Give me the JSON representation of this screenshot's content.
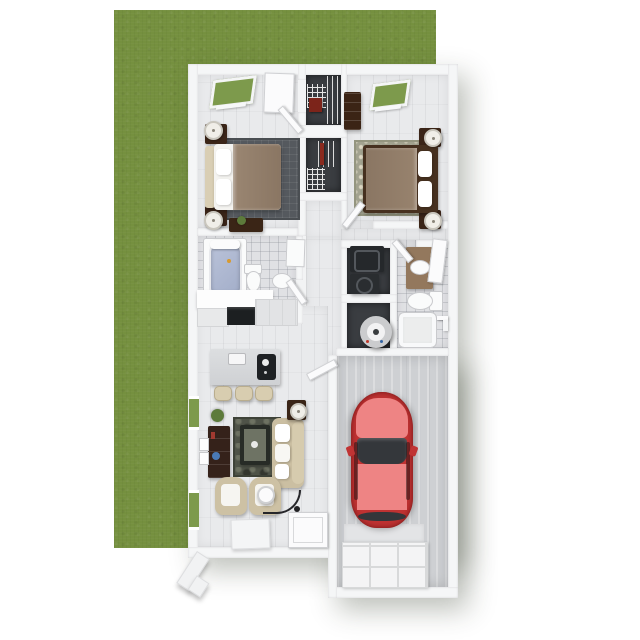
{
  "scene": {
    "title": "3D top-down floor plan render of a one-story apartment with attached single-car garage on a green lawn",
    "view": "overhead dollhouse 3D render",
    "background": "white"
  },
  "palette": {
    "lawn_green": "#75903f",
    "window_green": "#7d9a4c",
    "wall_white": "#f5f6f7",
    "wood_floor": "#e9eaec",
    "tile_floor": "#e0e1e4",
    "closet_dark": "#3a3d41",
    "garage_concrete": "#ced0d3",
    "furniture_wood_dark": "#3b2518",
    "upholstery_beige": "#cdc1a4",
    "blanket_taupe": "#8f7b67",
    "rug_charcoal": "#55595e",
    "rug_sage": "#a2a28f",
    "living_rug": "#4f5348",
    "car_body_red": "#bf3232",
    "car_panel_red": "#ee8484",
    "car_glass": "#34373b",
    "appliance_dark": "#25282b",
    "tub_blue": "#aeb8d2",
    "plant_green": "#5d7b3b"
  },
  "rooms": [
    {
      "name": "Bedroom 1",
      "furniture": [
        "queen bed with taupe blanket",
        "cream headboard",
        "2 nightstands with lamps",
        "charcoal grid rug",
        "desk with plant",
        "skylight window",
        "entry door"
      ]
    },
    {
      "name": "Closet 1",
      "furniture": [
        "white wire shelving",
        "hanging clothes"
      ]
    },
    {
      "name": "Closet 2",
      "furniture": [
        "white wire shelving",
        "hanging clothes"
      ]
    },
    {
      "name": "Bedroom 2",
      "furniture": [
        "queen bed with taupe blanket",
        "dark wood frame",
        "2 nightstands with lamps",
        "sage quatrefoil rug",
        "dresser",
        "skylight window"
      ]
    },
    {
      "name": "Bathroom 1",
      "furniture": [
        "bathtub with blue liner",
        "toilet",
        "pedestal sink",
        "white vanity counter",
        "wall cabinet"
      ]
    },
    {
      "name": "Hallway",
      "furniture": []
    },
    {
      "name": "Laundry closet",
      "furniture": [
        "stacked washer",
        "dryer"
      ]
    },
    {
      "name": "Water heater closet",
      "furniture": [
        "water heater"
      ]
    },
    {
      "name": "Bathroom 2",
      "furniture": [
        "vanity with sink and mirror door",
        "toilet",
        "bathtub",
        "towel bar"
      ]
    },
    {
      "name": "Kitchen",
      "furniture": [
        "range",
        "counters",
        "island with sink and cooktop",
        "3 bar stools"
      ]
    },
    {
      "name": "Living room",
      "furniture": [
        "beige sofa with pillows",
        "2 beige armchairs",
        "coffee table on dark rug",
        "media console",
        "arc floor lamp",
        "side table with lamp",
        "plant",
        "wall art",
        "2 windows"
      ]
    },
    {
      "name": "Entry",
      "furniture": [
        "front door",
        "door mat",
        "exterior walkway stoop"
      ]
    },
    {
      "name": "Garage",
      "furniture": [
        "red car",
        "garage door"
      ]
    }
  ],
  "vehicle": {
    "type": "car",
    "color": "red",
    "location": "garage",
    "orientation": "nose toward house"
  }
}
